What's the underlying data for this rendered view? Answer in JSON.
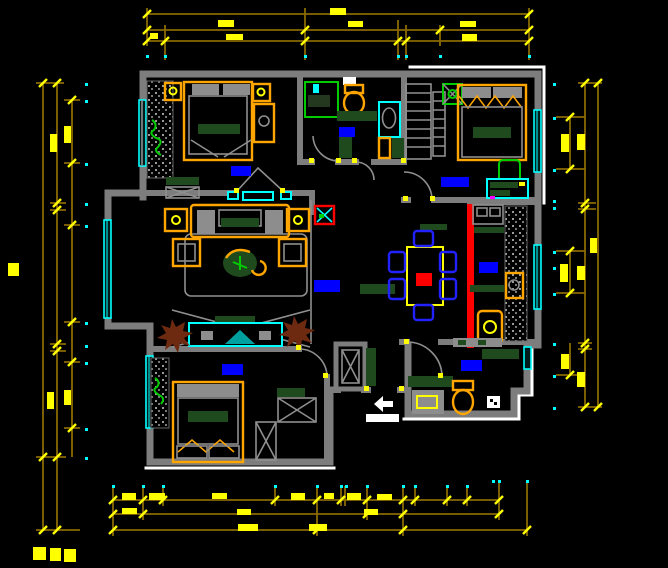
{
  "meta": {
    "drawing_type": "residential floor plan (CAD)",
    "canvas": {
      "width": 668,
      "height": 568
    },
    "background": "#000000",
    "text_legible": false
  },
  "palette": {
    "wall_gray": "#7d7d7d",
    "detail_gray": "#8f8f8f",
    "outline_white": "#ffffff",
    "dim_line_olive": "#8a6a00",
    "dim_accent_yellow": "#ffff00",
    "marker_cyan": "#00ffff",
    "window_cyan": "#00ffff",
    "label_blue": "#0000ff",
    "furniture_orange": "#ffa500",
    "furniture_dark_green": "#1e4a1e",
    "plant_bright_green": "#00cc00",
    "accent_red": "#ff0000",
    "plant_brown": "#6e2a10",
    "chair_blue": "#2222ff",
    "magenta_dot": "#ff00ff"
  },
  "dimension_chains": {
    "top": {
      "rows": 3,
      "tick_style": "diagonal yellow slash",
      "end_markers": "cyan dots",
      "values_legible": false
    },
    "bottom": {
      "rows": 3,
      "tick_style": "diagonal yellow slash",
      "end_markers": "cyan dots",
      "values_legible": false
    },
    "left": {
      "columns": 3,
      "rotated_text": true,
      "values_legible": false
    },
    "right": {
      "columns": 2,
      "sub_chain": true,
      "rotated_text": true,
      "values_legible": false
    }
  },
  "rooms": [
    {
      "id": "bedroom-top-left",
      "label_color": "#0000ff",
      "furniture": [
        "double-bed",
        "nightstand",
        "nightstand",
        "vanity",
        "foot-bench",
        "decor-texture-wall",
        "plant",
        "window"
      ]
    },
    {
      "id": "bathroom-top",
      "label_color": "#0000ff",
      "furniture": [
        "shower-enclosure",
        "toilet",
        "washbasin",
        "cabinet"
      ]
    },
    {
      "id": "closet-column",
      "label_color": null,
      "furniture": [
        "shelf-ladder",
        "shelf-ladder"
      ]
    },
    {
      "id": "bedroom-top-right",
      "label_color": "#0000ff",
      "furniture": [
        "double-bed",
        "plant-box",
        "desk",
        "desk-chair",
        "window"
      ]
    },
    {
      "id": "living-room",
      "label_color": "#0000ff",
      "furniture": [
        "sofa-set",
        "side-table",
        "side-table",
        "armchair",
        "armchair",
        "coffee-table-plant",
        "rug",
        "tv-cabinet",
        "potted-plant",
        "potted-plant",
        "window"
      ]
    },
    {
      "id": "dining-room",
      "label_color": null,
      "furniture": [
        "dining-table",
        "dining-chair",
        "dining-chair",
        "dining-chair",
        "dining-chair",
        "dining-chair",
        "dining-chair",
        "sideboard"
      ]
    },
    {
      "id": "kitchen",
      "label_color": "#0000ff",
      "furniture": [
        "counter-sink",
        "counter",
        "appliance",
        "water-heater",
        "stove-row",
        "pantry-texture",
        "red-partition"
      ]
    },
    {
      "id": "bedroom-bottom-left",
      "label_color": "#0000ff",
      "furniture": [
        "double-bed",
        "drawer-chest",
        "wardrobe-x-boxes",
        "decor-texture-wall",
        "plant",
        "window"
      ]
    },
    {
      "id": "bathroom-bottom-right",
      "label_color": "#0000ff",
      "furniture": [
        "toilet",
        "washbasin",
        "counter",
        "counter",
        "window"
      ]
    },
    {
      "id": "hallway",
      "label_color": null,
      "furniture": [
        "ac-unit-box",
        "shoe-sill",
        "shoe-sill",
        "shoe-sill",
        "shaft-x",
        "entry-arrow",
        "entry-mat"
      ]
    }
  ],
  "symbols": {
    "door_swing": "gray quarter-arc with yellow hinge dots",
    "window": "cyan double line in wall",
    "room_label": "solid blue text blob (illegible)",
    "dimension_text": "solid yellow blob (illegible)",
    "entry": "white arrow + white mat"
  }
}
